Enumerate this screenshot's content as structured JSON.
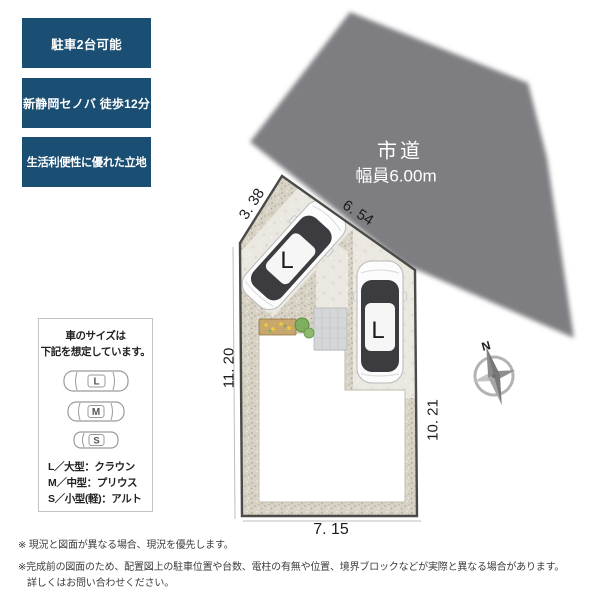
{
  "badges": [
    {
      "label": "駐車2台可能"
    },
    {
      "label": "新静岡セノバ 徒歩12分"
    },
    {
      "label": "生活利便性に優れた立地"
    }
  ],
  "road": {
    "name": "市道",
    "width_label": "幅員6.00m"
  },
  "site": {
    "dimensions": {
      "edge_top_left_diagonal": "3. 38",
      "edge_top": "6. 54",
      "edge_left": "11. 20",
      "edge_right": "10. 21",
      "edge_bottom": "7. 15"
    },
    "cars": [
      {
        "label": "L"
      },
      {
        "label": "L"
      }
    ]
  },
  "compass": {
    "north_label": "N"
  },
  "legend": {
    "title_line1": "車のサイズは",
    "title_line2": "下記を想定しています。",
    "items": [
      {
        "letter": "L",
        "desc": "L／大型：クラウン"
      },
      {
        "letter": "M",
        "desc": "M／中型：プリウス"
      },
      {
        "letter": "S",
        "desc": "S／小型(軽)：アルト"
      }
    ]
  },
  "footnotes": {
    "line1": "※ 現況と図面が異なる場合、現況を優先します。",
    "line2": "※完成前の図面のため、配置図上の駐車位置や台数、電柱の有無や位置、境界ブロックなどが実際と異なる場合があります。",
    "line3": "詳しくはお問い合わせください。"
  },
  "colors": {
    "badge_bg": "#1b4e73",
    "road": "#7e7e82",
    "gravel": "#d7d2c5",
    "concrete": "#eae8e1",
    "boundary": "#4a4a48",
    "building": "#ffffff"
  }
}
